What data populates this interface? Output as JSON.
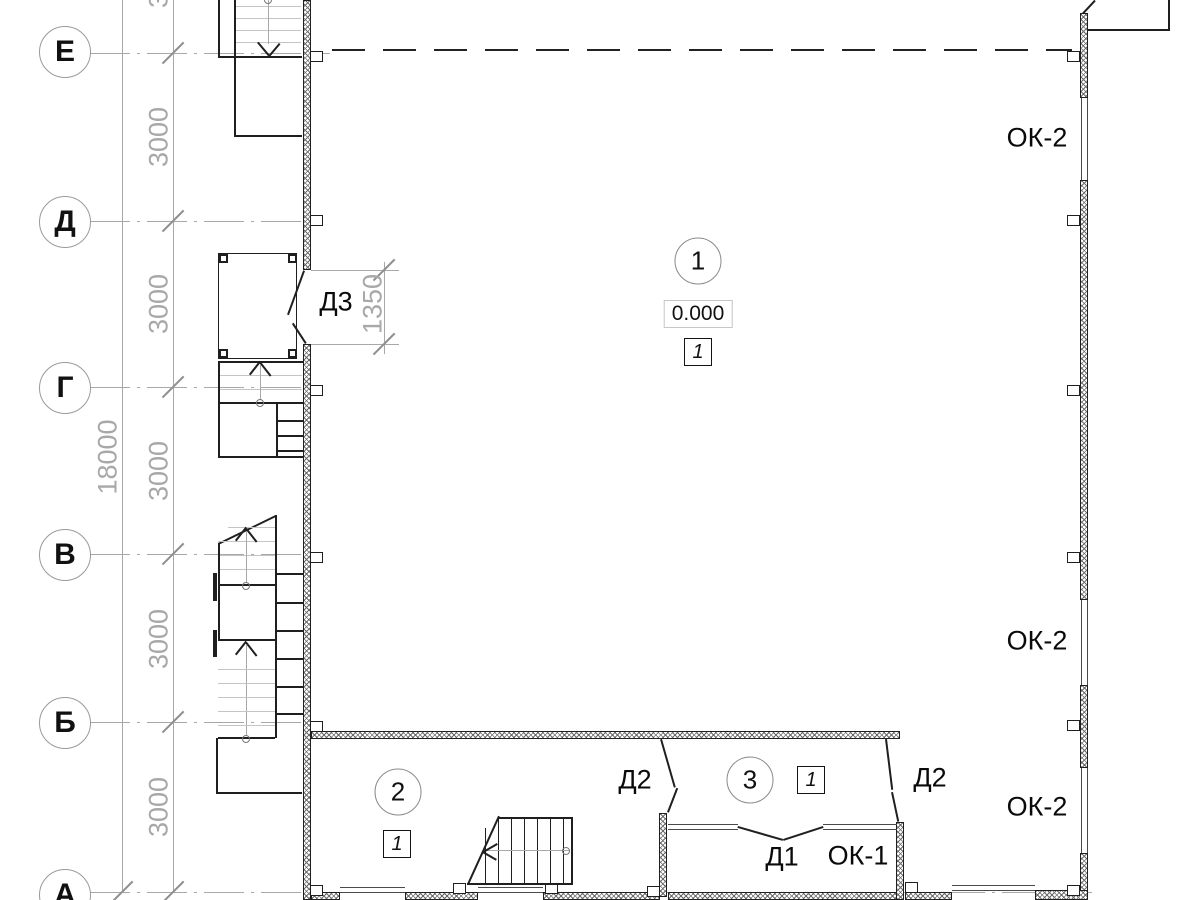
{
  "axes": {
    "e": "Е",
    "d": "Д",
    "g": "Г",
    "v": "В",
    "b": "Б",
    "a": "А"
  },
  "dimensions": {
    "bay": "3000",
    "total": "18000",
    "door_d3": "1350"
  },
  "rooms": {
    "r1": {
      "number": "1",
      "level": "0.000",
      "finish": "1"
    },
    "r2": {
      "number": "2",
      "finish": "1"
    },
    "r3": {
      "number": "3",
      "finish": "1"
    }
  },
  "openings": {
    "d1": "Д1",
    "d2": "Д2",
    "d3": "Д3",
    "ok1": "ОК-1",
    "ok2": "ОК-2"
  },
  "colors": {
    "line": "#1f1f1f",
    "axis_grey": "#a8a8a8",
    "tread_grey": "#c4c4c4",
    "hatch": "#6a6a6a",
    "background": "#ffffff"
  }
}
